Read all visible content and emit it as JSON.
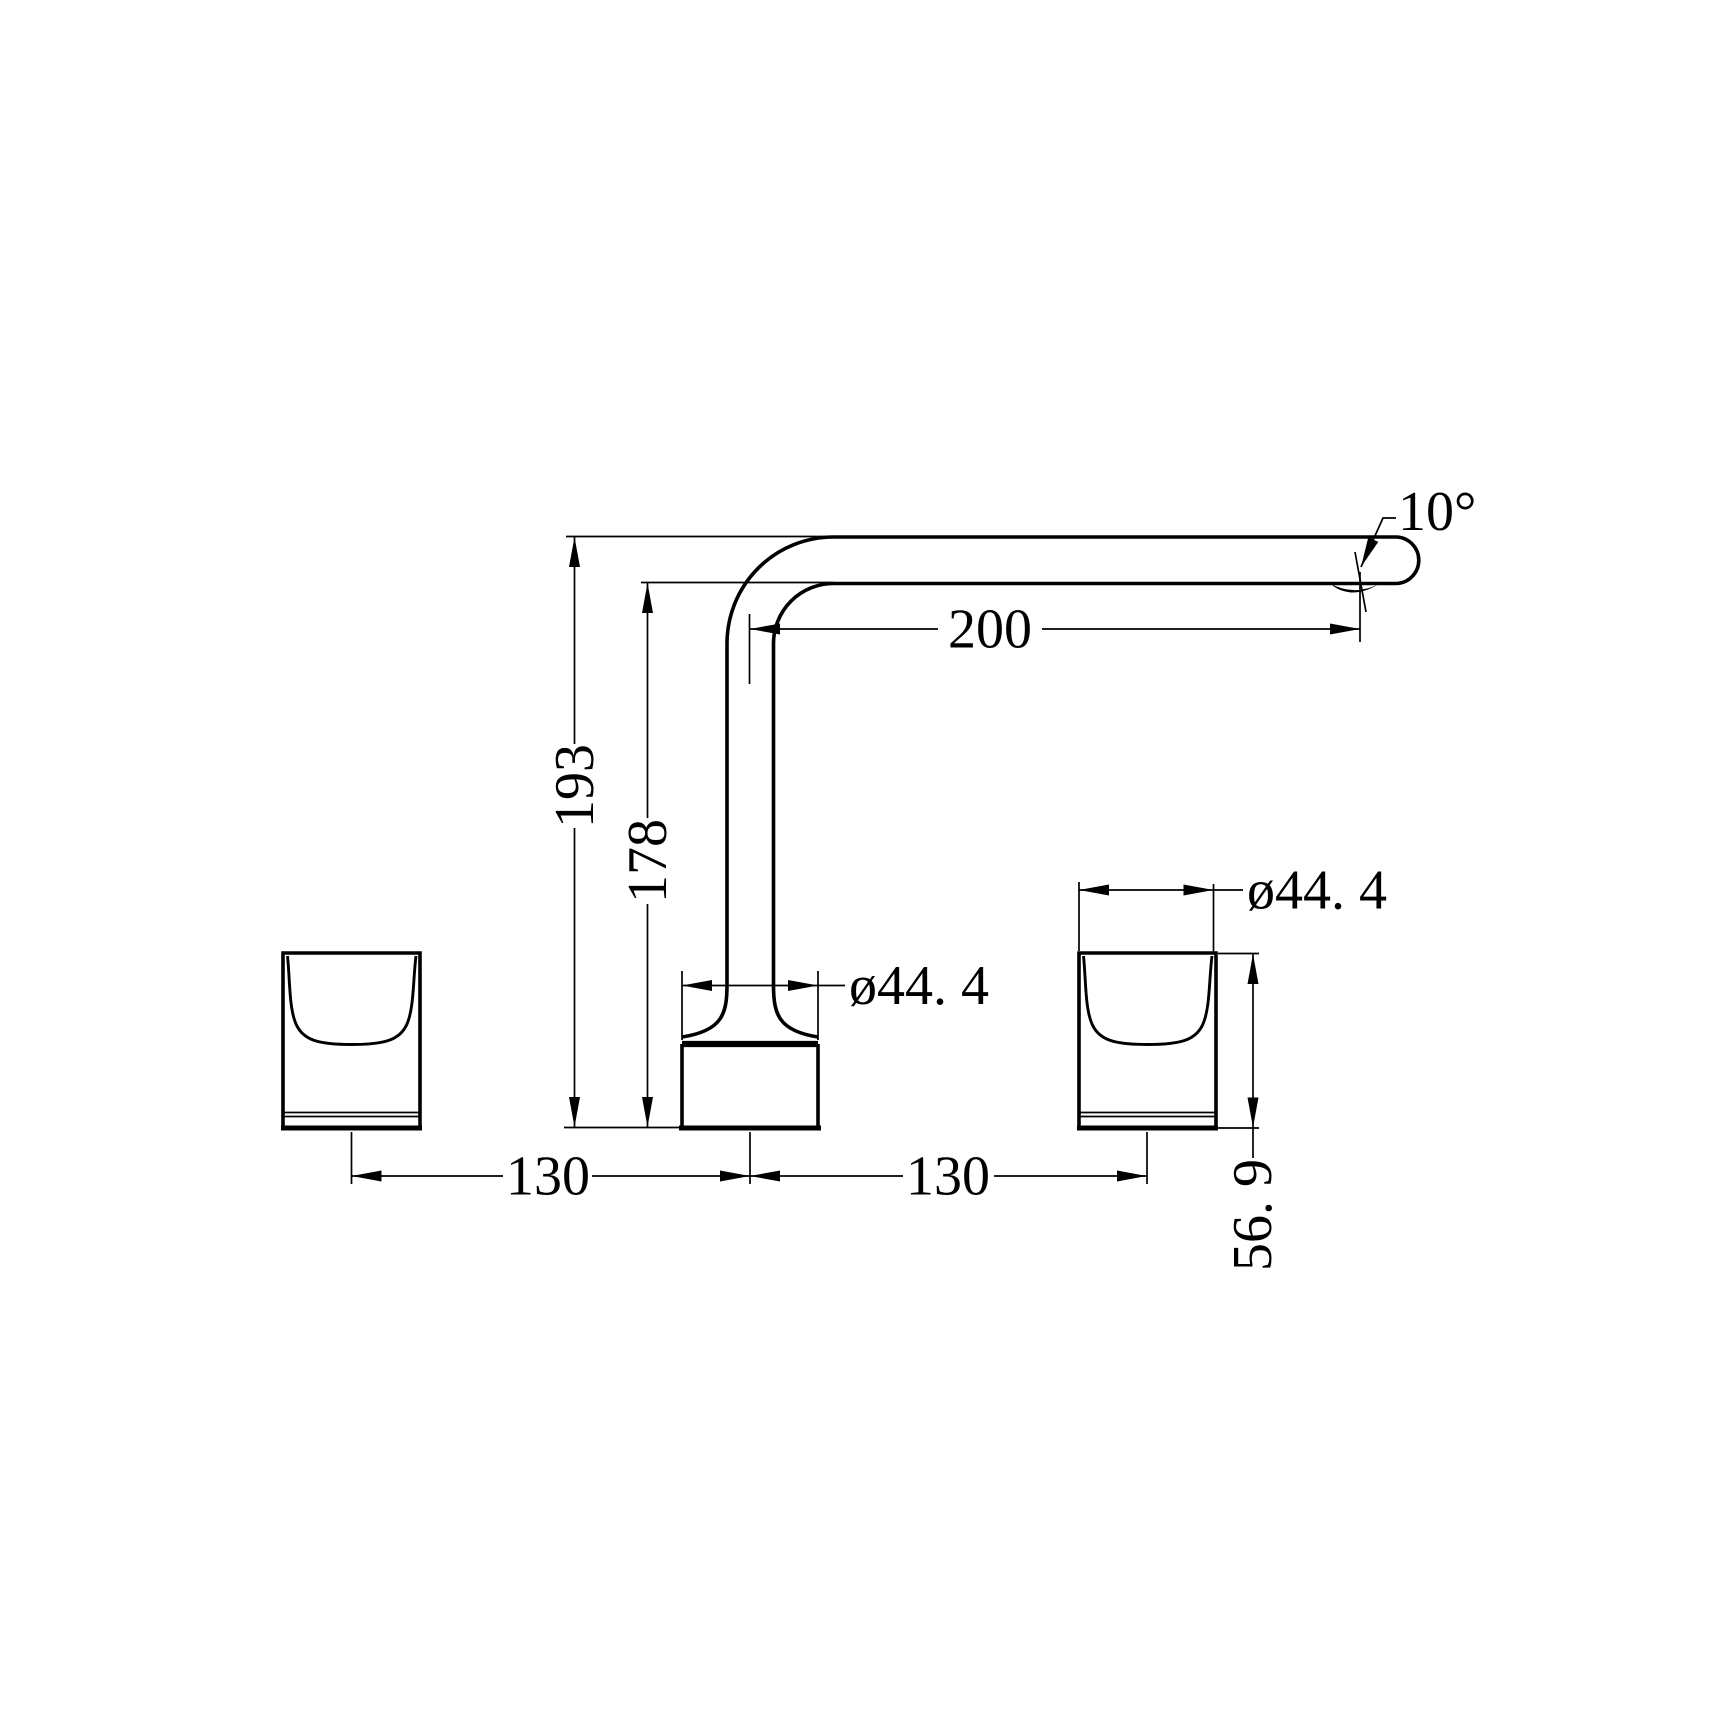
{
  "document": {
    "kind": "technical dimension drawing",
    "background_color": "#ffffff",
    "line_color": "#000000"
  },
  "dimensions": {
    "overall_height": "193",
    "spout_underside_height": "178",
    "spout_reach": "200",
    "outlet_angle": "10°",
    "body_diameter": "ø44. 4",
    "handle_diameter": "ø44. 4",
    "spacing_left": "130",
    "spacing_right": "130",
    "handle_height": "56. 9"
  }
}
